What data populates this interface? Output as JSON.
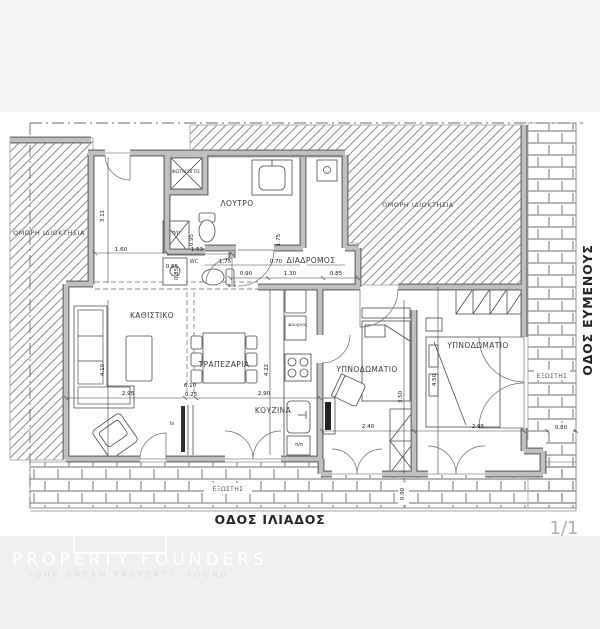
{
  "plan": {
    "room_labels": {
      "living": "ΚΑΘΙΣΤΙΚΟ",
      "dining": "ΤΡΑΠΕΖΑΡΙΑ",
      "kitchen": "ΚΟΥΖΙΝΑ",
      "bath": "ΛΟΥΤΡΟ",
      "wc": "WC",
      "corridor": "ΔΙΑΔΡΟΜΟΣ",
      "bedroom1": "ΥΠΝΟΔΩΜΑΤΙΟ",
      "bedroom2": "ΥΠΝΟΔΩΜΑΤΙΟ",
      "lightwell": "ΦΩΤΑΓΩΓΟΣ",
      "adjacent_left": "ΟΜΟΡΗ ΙΔΙΟΚΤΗΣΙΑ",
      "adjacent_right": "ΟΜΟΡΗ ΙΔΙΟΚΤΗΣΙΑ",
      "balcony_right": "ΕΞΩΣΤΗΣ",
      "balcony_bottom": "ΕΞΩΣΤΗΣ"
    },
    "fixture_labels": {
      "tv": "tv",
      "oven": "φουρνος",
      "pantry": "π/ρ",
      "appliance": "π/π"
    },
    "streets": {
      "bottom": "ΟΔΟΣ ΙΛΙΑΔΟΣ",
      "right": "ΟΔΟΣ ΕΥΜΕΝΟΥΣ"
    },
    "dims": {
      "hall_w": "1.60",
      "hall_h": "3.11",
      "closet_h": "0.95",
      "closet_w": "0.65",
      "wc_w": "1.53",
      "wc_h": "0.85",
      "bath_w": "1.75",
      "shower_w": "0.70",
      "shower_h": "1.75",
      "corr_1": "0.90",
      "corr_2": "1.30",
      "corr_3": "0.85",
      "living_w": "2.95",
      "wall_t": "0.25",
      "dining_w": "2.90",
      "total_w": "6.10",
      "kitchen_h": "4.22",
      "living_h": "4.10",
      "bed1_w": "2.40",
      "bed1_h": "3.50",
      "bed2_h": "4.50",
      "bed2_w": "2.95",
      "balc_right_w": "0.80",
      "balc_bottom": "0.90"
    },
    "colors": {
      "wall_gray": "#c0c0c0",
      "hatch_gray": "#8f8f8f",
      "footer_bg": "#efefef",
      "top_band_bg": "#f4f4f5"
    }
  },
  "page_number": "1/1",
  "watermark": {
    "title": "PROPERTY FOUNDERS",
    "tagline": "YOUR DREAM PROPERTY, FOUND"
  }
}
